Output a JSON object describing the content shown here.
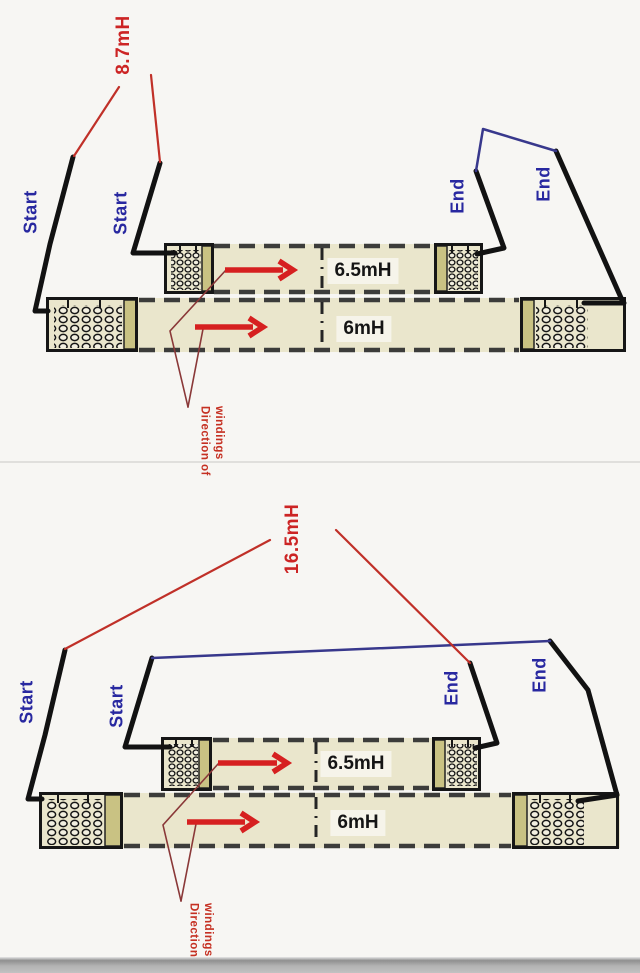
{
  "page": {
    "background": "#f7f6f3",
    "divider_color": "#e0dfdc",
    "bottom_strip_color": "#b2b2b2"
  },
  "colors": {
    "wire_black": "#121212",
    "wire_blue": "#38388c",
    "leader_red": "#c03028",
    "leader_maroon": "#8a3838",
    "arrow_red": "#d62020",
    "lead_label_blue": "#2828a0",
    "measurement_red": "#cc2424",
    "note_red": "#c53022",
    "core_fill": "#eae6cc",
    "core_border": "#3c3c3a",
    "flange_fill": "#c9c283"
  },
  "diagrams": [
    {
      "measurement": "8.7mH",
      "lead_labels": {
        "outer_left": "Start",
        "inner_left": "Start",
        "inner_right": "End",
        "outer_right": "End"
      },
      "windings": [
        {
          "value": "6.5mH"
        },
        {
          "value": "6mH"
        }
      ],
      "note_line1": "Direction of",
      "note_line2": "windings"
    },
    {
      "measurement": "16.5mH",
      "lead_labels": {
        "outer_left": "Start",
        "inner_left": "Start",
        "inner_right": "End",
        "outer_right": "End"
      },
      "windings": [
        {
          "value": "6.5mH"
        },
        {
          "value": "6mH"
        }
      ],
      "note_line1": "Direction of",
      "note_line2": "windings"
    }
  ]
}
